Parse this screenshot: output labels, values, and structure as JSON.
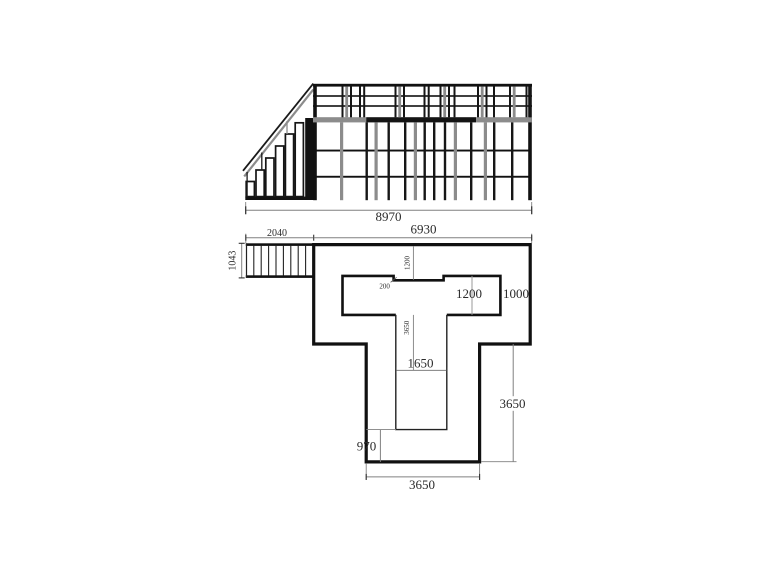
{
  "drawing": {
    "type": "scaffold-stair-platform-technical-drawing",
    "views": {
      "elevation_label": "side elevation of stair and scaffold platform",
      "plan_label": "plan of platform deck with T-shaped opening"
    }
  },
  "colors": {
    "line": "#111111",
    "gray_member": "#8c8c8c",
    "dim_line": "#808080",
    "text": "#2b2b2b",
    "background": "#ffffff"
  },
  "elevation": {
    "total_width_label": "8970"
  },
  "plan": {
    "stair_width_label": "2040",
    "stair_depth_label": "1043",
    "platform_width_label": "6930",
    "opening_top_offset_label": "1200",
    "notch_label": "200",
    "opening_height_label": "1200",
    "right_margin_label": "1000",
    "stem_depth_small_label": "3650",
    "stem_opening_width_label": "1650",
    "right_depth_label": "3650",
    "bottom_offset_label": "970",
    "stem_width_label": "3650"
  }
}
